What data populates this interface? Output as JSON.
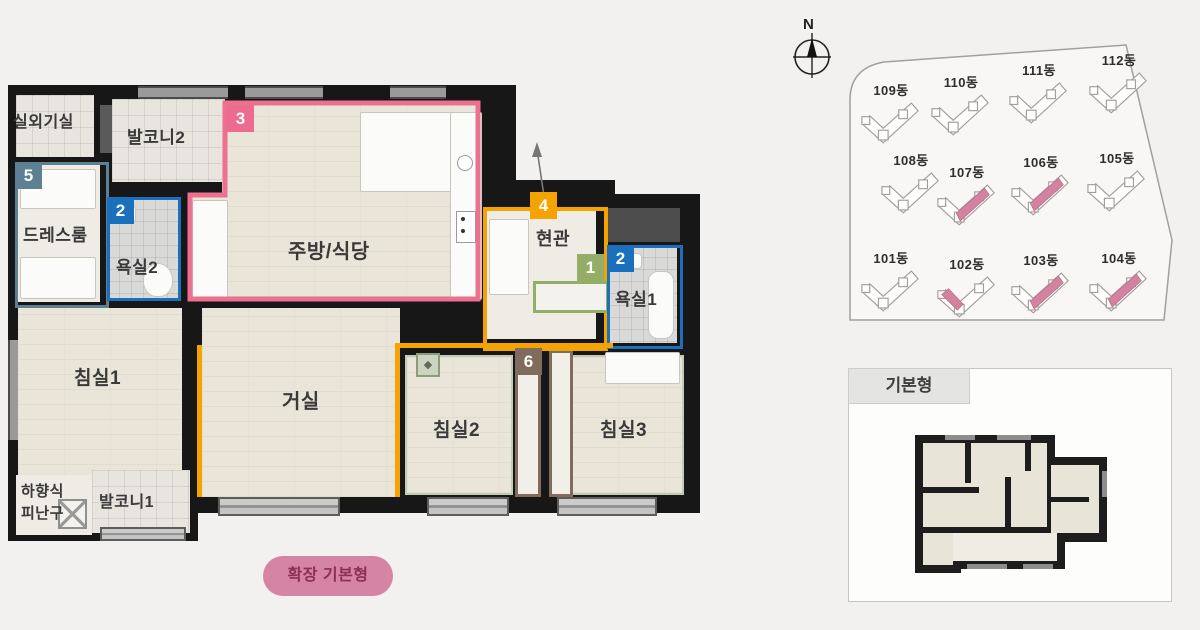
{
  "plan": {
    "rooms": {
      "outdoor_unit": "실외기실",
      "balcony2": "발코니2",
      "dressroom": "드레스룸",
      "bath2": "욕실2",
      "kitchen": "주방/식당",
      "entrance": "현관",
      "bath1": "욕실1",
      "bedroom1": "침실1",
      "living": "거실",
      "bedroom2": "침실2",
      "bedroom3": "침실3",
      "escape_line1": "하향식",
      "escape_line2": "피난구",
      "balcony1": "발코니1"
    },
    "markers": [
      {
        "number": "1",
        "color": "#95ae67"
      },
      {
        "number": "2",
        "color": "#1b70bd"
      },
      {
        "number": "3",
        "color": "#ec6b8e"
      },
      {
        "number": "4",
        "color": "#f5a302"
      },
      {
        "number": "5",
        "color": "#5d8093"
      },
      {
        "number": "6",
        "color": "#7f6c5d"
      }
    ]
  },
  "button": {
    "label": "확장 기본형",
    "background": "#d584a3",
    "text_color": "#8c2f55"
  },
  "site_plan": {
    "compass_label": "N",
    "highlight_color": "#d382a0",
    "buildings": [
      {
        "label": "109동",
        "highlighted": false
      },
      {
        "label": "110동",
        "highlighted": false
      },
      {
        "label": "111동",
        "highlighted": false
      },
      {
        "label": "112동",
        "highlighted": false
      },
      {
        "label": "108동",
        "highlighted": false
      },
      {
        "label": "107동",
        "highlighted": true
      },
      {
        "label": "106동",
        "highlighted": true
      },
      {
        "label": "105동",
        "highlighted": false
      },
      {
        "label": "101동",
        "highlighted": false
      },
      {
        "label": "102동",
        "highlighted": true
      },
      {
        "label": "103동",
        "highlighted": true
      },
      {
        "label": "104동",
        "highlighted": true
      }
    ]
  },
  "thumbnail": {
    "label": "기본형"
  }
}
